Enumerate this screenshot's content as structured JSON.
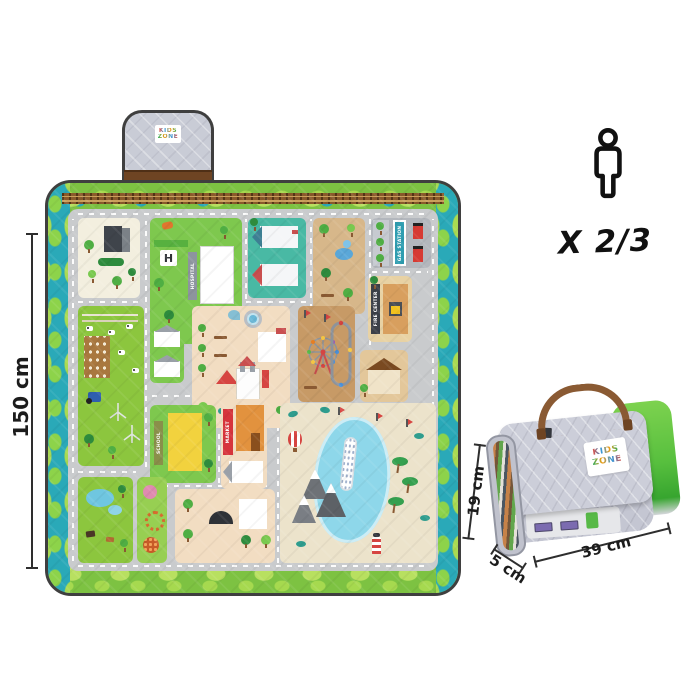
{
  "mat": {
    "height_label": "150 cm",
    "width_label": "150 cm",
    "logo": {
      "word1": "KIDS",
      "word2": "ZONE"
    },
    "signs": {
      "hospital": "HOSPITAL",
      "helipad": "H",
      "gas_station": "GAS STATION",
      "fire_center": "FIRE CENTER",
      "school": "SCHOOL",
      "market": "MARKET"
    }
  },
  "capacity": {
    "label": "X 2/3"
  },
  "folded_mat": {
    "height_label": "19 cm",
    "depth_label": "5 cm",
    "width_label": "39 cm",
    "logo": {
      "word1": "KIDS",
      "word2": "ZONE"
    }
  },
  "colors": {
    "border_green": "#7dc242",
    "border_teal": "#2aa9b8",
    "road_gray": "#c9cbcd",
    "grass_green": "#8cc63e",
    "plaza_tan": "#f2ddc2",
    "water_blue": "#8ed7ea",
    "rail_brown": "#8a5a2b",
    "bag_gray": "#c7c9d4",
    "handle_brown": "#8a5a33",
    "dimension_line": "#2e2e2e"
  }
}
